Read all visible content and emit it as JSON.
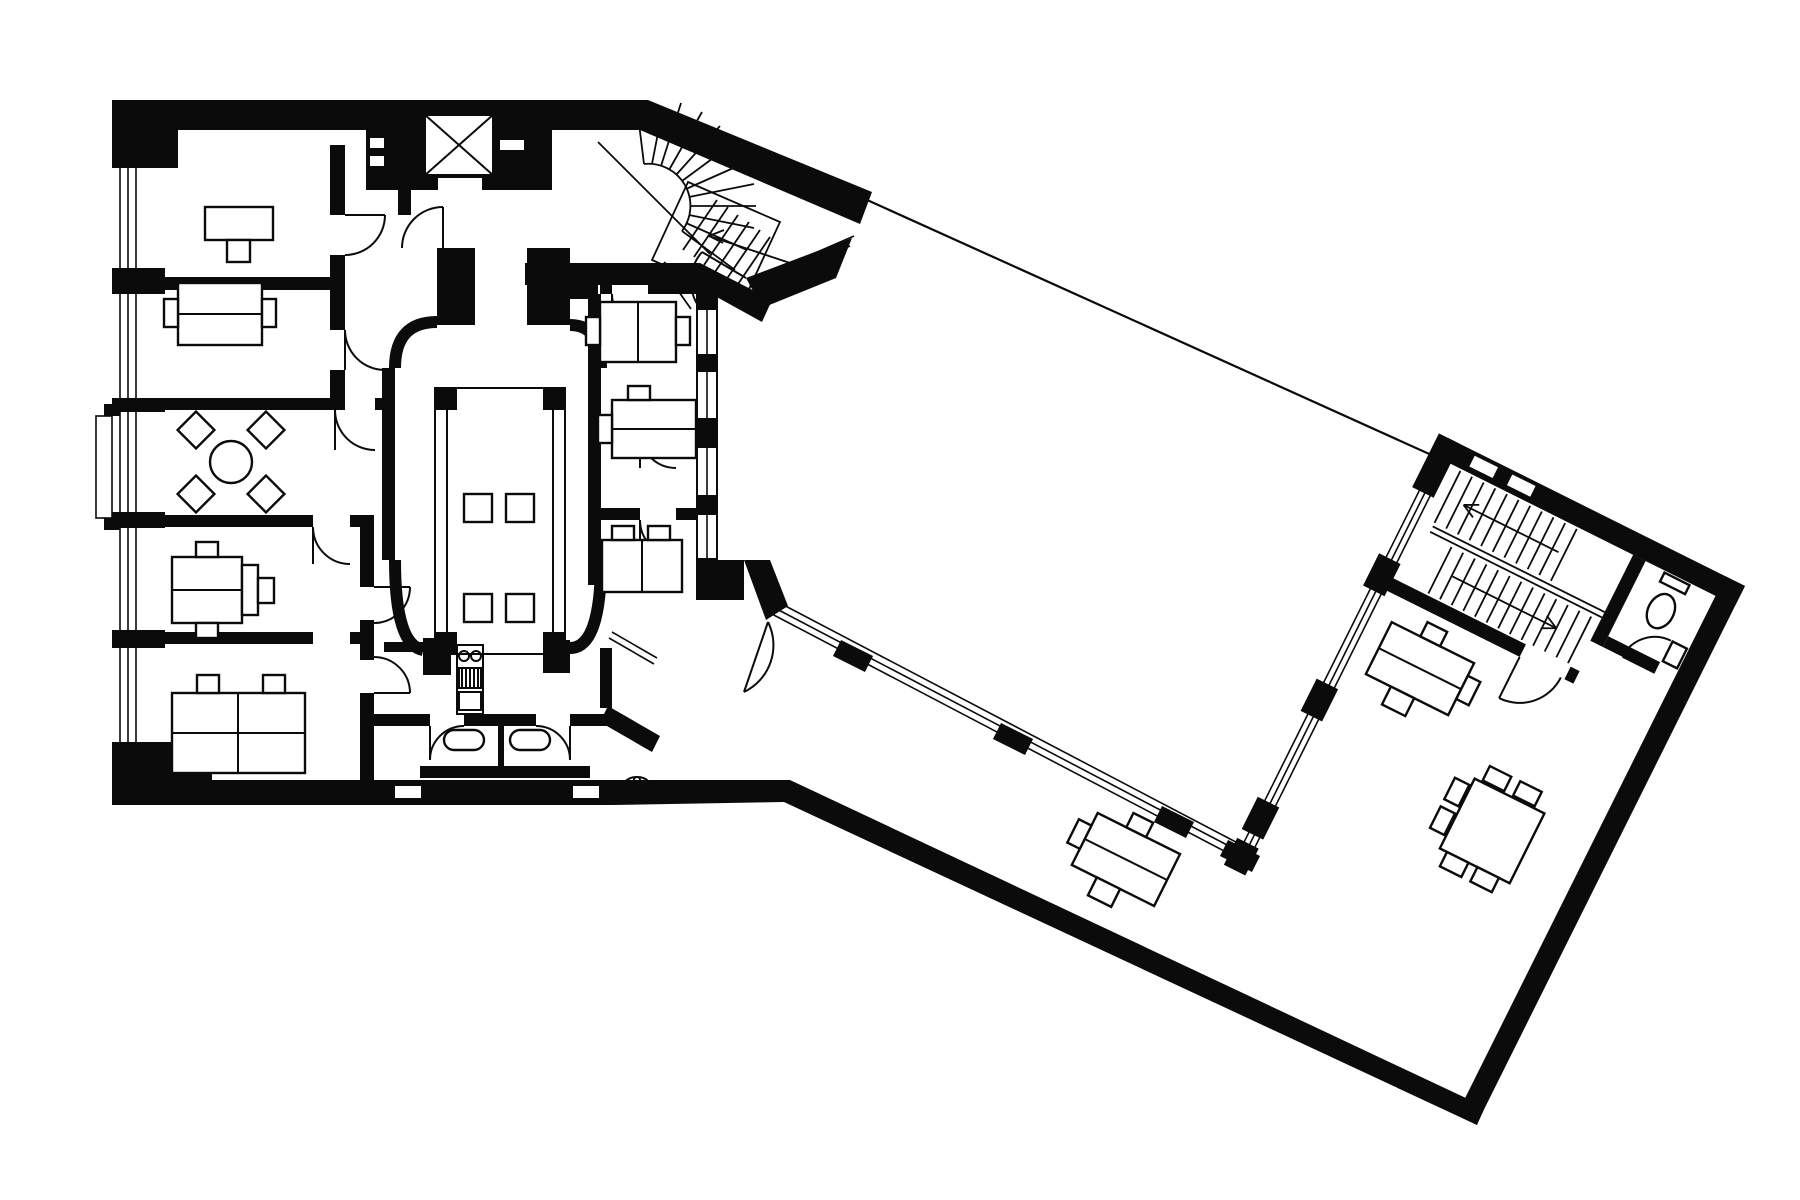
{
  "meta": {
    "description": "Black and white architectural floor plan: rectangular office block linked by a glazed corridor to a rotated wing on an angled site",
    "drawing_type": "floor-plan",
    "medium": "ink on paper"
  },
  "colors": {
    "ink": "#0b0b0b",
    "paper": "#ffffff"
  },
  "site_boundary": {
    "x1": "845",
    "y1": "190",
    "x2": "1447",
    "y2": "462"
  },
  "left_block": {
    "west_rooms": [
      {
        "furniture": "desk-with-chair"
      },
      {
        "furniture": "desk-with-two-side-chairs"
      },
      {
        "furniture": "round-table-with-four-diamond-chairs"
      },
      {
        "furniture": "desk-with-chair-and-side-seats"
      },
      {
        "furniture": "double-desk-with-four-chairs"
      }
    ],
    "east_rooms": [
      {
        "furniture": "desk-with-two-side-chairs"
      },
      {
        "furniture": "desk-with-chair"
      },
      {
        "furniture": "desk-with-two-chairs"
      }
    ],
    "core": {
      "elevator": 1,
      "curved_main_stair": 1,
      "central_hall_long_table_stools": 4,
      "kitchenette": 1,
      "wc_stalls": 2,
      "washbasin": 1
    }
  },
  "link_corridor": {
    "glazed_side": "courtyard",
    "window_piers": 3
  },
  "right_wing": {
    "transform": "translate(1447,462) rotate(26.5)",
    "rotation_degrees": 26.5,
    "dogleg_stair": 1,
    "wc": 1,
    "desks": 2,
    "meeting_table_chairs": 6
  }
}
